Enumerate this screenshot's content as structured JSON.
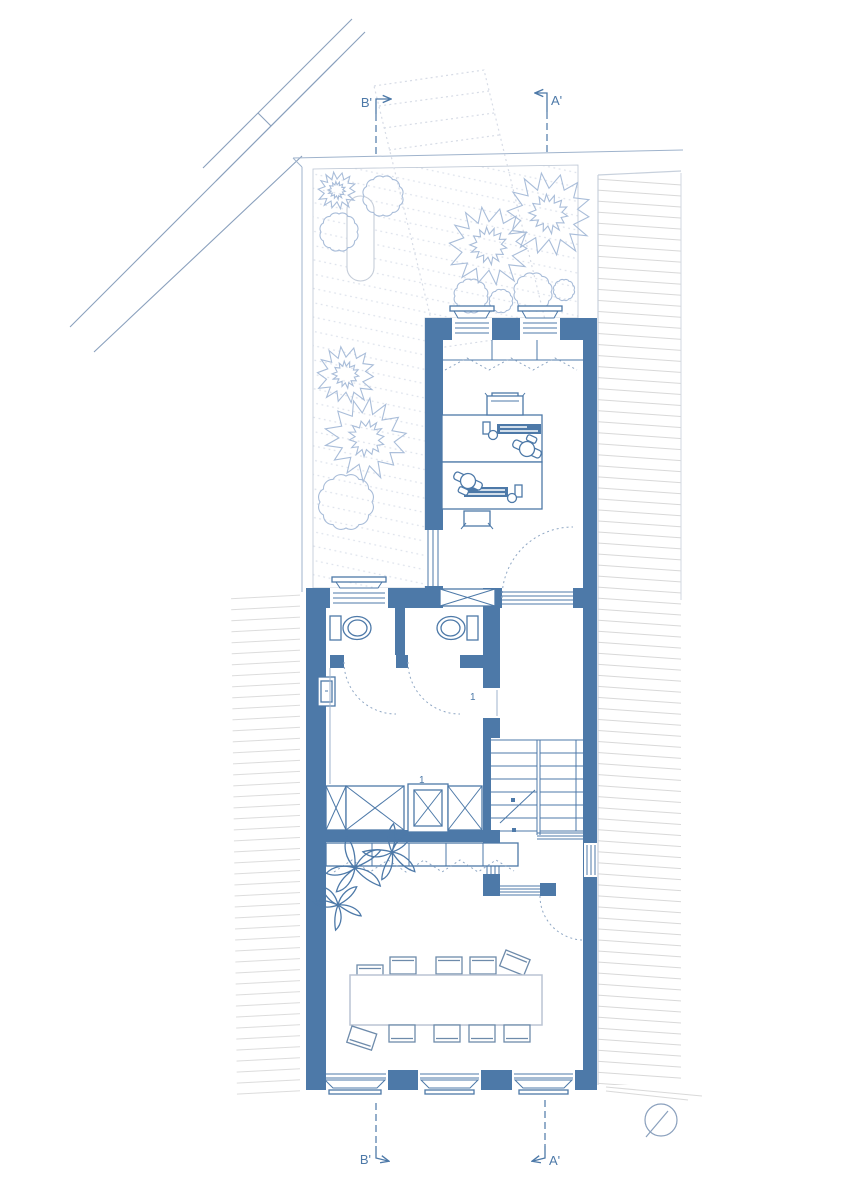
{
  "title": "ground floor plan",
  "markers": {
    "b_top": "B'",
    "a_top": "A'",
    "b_bottom": "B'",
    "a_bottom": "A'"
  },
  "doors": {
    "hall": "1",
    "elevator": "1"
  },
  "colors": {
    "wall": "#4d79a8",
    "vegetation": "#a9bdd9",
    "context_hatch": "#d9d9d9",
    "garden_hatch": "#dee3ec",
    "light_line": "#9fb3cc",
    "paper": "#ffffff"
  }
}
